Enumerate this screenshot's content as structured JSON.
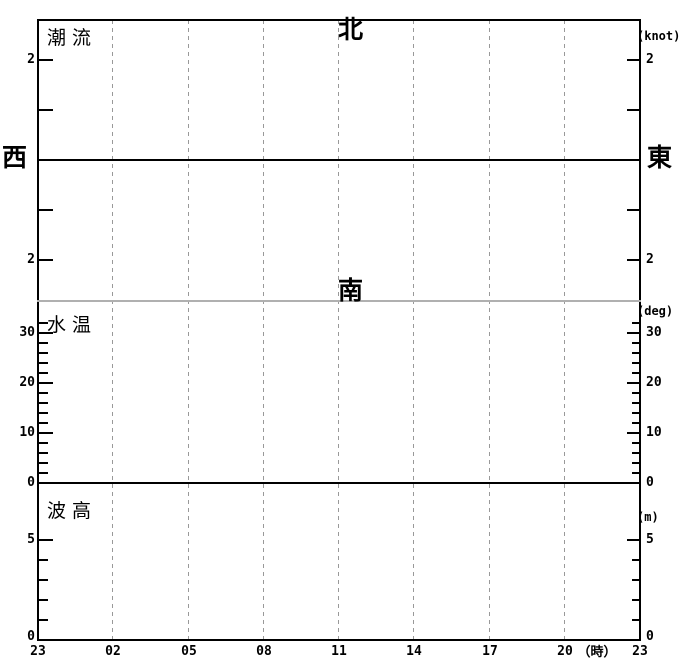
{
  "chart_data": {
    "type": "line",
    "title": "24-hour marine forecast chart (tidal current, water temperature, wave height)",
    "grid": "vertical dashed gridlines every 3 hours, full chart height",
    "legend": "none",
    "x_axis": {
      "tick_labels": [
        "23",
        "02",
        "05",
        "08",
        "11",
        "14",
        "17",
        "20",
        "23"
      ],
      "gridline_labels": [
        "02",
        "05",
        "08",
        "11",
        "14",
        "17",
        "20"
      ],
      "unit_label": "（時）",
      "range_hours": 24
    },
    "panels": [
      {
        "key": "tidal-current",
        "title": "潮流",
        "unit_label": "(knot)",
        "compass": {
          "north": "北",
          "south": "南",
          "west": "西",
          "east": "東"
        },
        "ylim": [
          -2.8,
          2.8
        ],
        "zero_line": true,
        "y_ticks": [
          {
            "value": 2,
            "label": "2"
          },
          {
            "value": 1,
            "label": ""
          },
          {
            "value": -1,
            "label": ""
          },
          {
            "value": -2,
            "label": "2"
          }
        ],
        "y_minor_ticks": [],
        "series": []
      },
      {
        "key": "water-temp",
        "title": "水温",
        "unit_label": "(deg)",
        "ylim": [
          0,
          36.4
        ],
        "zero_line": true,
        "y_ticks": [
          {
            "value": 30,
            "label": "30"
          },
          {
            "value": 20,
            "label": "20"
          },
          {
            "value": 10,
            "label": "10"
          },
          {
            "value": 0,
            "label": "0"
          }
        ],
        "y_minor_ticks": [
          2,
          4,
          6,
          8,
          12,
          14,
          16,
          18,
          22,
          24,
          26,
          28,
          32
        ],
        "series": []
      },
      {
        "key": "wave-height",
        "title": "波高",
        "unit_label": "(m)",
        "ylim": [
          0,
          7.85
        ],
        "zero_line": false,
        "y_ticks": [
          {
            "value": 5,
            "label": "5"
          },
          {
            "value": 0,
            "label": "0"
          }
        ],
        "y_minor_ticks": [
          1,
          2,
          3,
          4
        ],
        "series": []
      }
    ],
    "colors": {
      "axis": "#000000",
      "gridline": "#999999",
      "panel_divider": "#b0b0b0",
      "background": "#ffffff",
      "text": "#000000"
    }
  }
}
